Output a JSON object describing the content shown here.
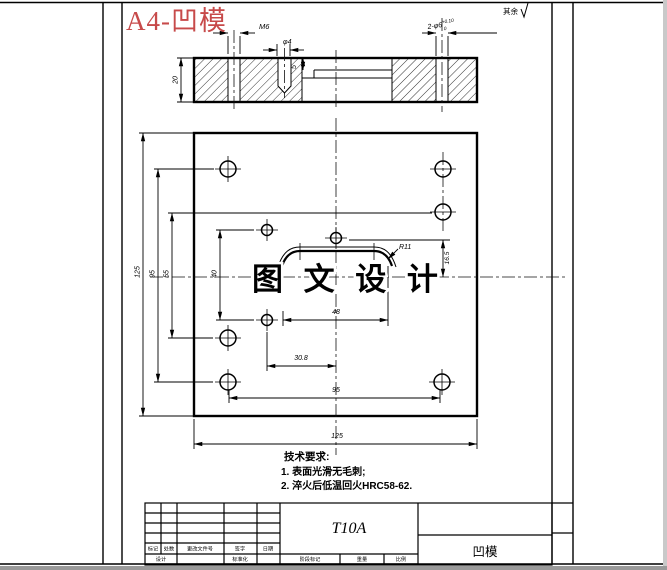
{
  "title": "A4-凹模",
  "surface_note": "其余",
  "watermark": "图 文 设 计",
  "dims": {
    "m6": "M6",
    "phi4": "φ4",
    "holes": "2-φ6",
    "holes_sup": "+0.10",
    "holes_sub": "0",
    "thickness": "20",
    "step": "5",
    "plate_height": "125",
    "v95": "95",
    "v55": "55",
    "v40": "40",
    "h48": "48",
    "h308": "30.8",
    "h95": "95",
    "h125": "125",
    "v165": "16.5",
    "r11": "R11"
  },
  "tech": {
    "heading": "技术要求:",
    "items": [
      "1. 表面光滑无毛刺;",
      "2. 淬火后低温回火HRC58-62."
    ]
  },
  "title_block": {
    "material": "T10A",
    "part_name": "凹模",
    "row1": [
      "标记",
      "处数",
      "更改文件号",
      "签字",
      "日期"
    ],
    "row2": [
      "设计",
      "标准化"
    ],
    "row3": [
      "阶段标记",
      "重量",
      "比例"
    ]
  },
  "colors": {
    "title_red": "#c74a4a",
    "line_black": "#000000",
    "watermark_gray": "#3c3c3c"
  }
}
